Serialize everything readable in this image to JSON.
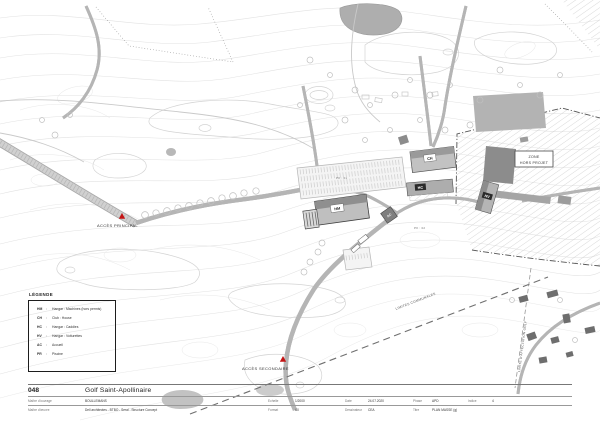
{
  "legend": {
    "title": "LÉGENDE",
    "sep": ":",
    "entries": [
      {
        "code": "HM",
        "label": "Hangar : Machines (hors permis)"
      },
      {
        "code": "CH",
        "label": "Club : House"
      },
      {
        "code": "HC",
        "label": "Hangar : Caddies"
      },
      {
        "code": "HV",
        "label": "Hangar : Voiturettes"
      },
      {
        "code": "AC",
        "label": "Accueil"
      },
      {
        "code": "PR",
        "label": "Piscine"
      }
    ]
  },
  "map": {
    "labels": {
      "access_main": "ACCÈS PRINCIPAL",
      "access_secondary": "ACCÈS SECONDAIRE",
      "zone_line1": "ZONE",
      "zone_line2": "HORS PROJET",
      "limit_communal": "LIMITES COMMUNALES",
      "limit_golf": "LIMITE D'AFFECTATION GOLF",
      "pk1": "PK : 01",
      "pk2": "PK : 02",
      "b_hm": "HM",
      "b_ch": "CH",
      "b_hc": "HC",
      "b_hv": "HV",
      "b_ac": "AC"
    },
    "colors": {
      "marker_red": "#c41414",
      "building_gray": "#9a9a9a",
      "hatch_gray": "#c9c9c9"
    }
  },
  "titleblock": {
    "number": "048",
    "project": "Golf Saint-Apollinaire",
    "row1": {
      "client_label": "Maître d'ouvrage",
      "client_value": "BOULLEMANS",
      "scale_label": "Echelle",
      "scale_value": "1/2000",
      "date_label": "Date",
      "date_value": "24.07.2020",
      "phase_label": "Phase",
      "phase_value": "APD",
      "index_label": "Indice",
      "index_value": "4"
    },
    "row2": {
      "architect_label": "Maître d'œuvre",
      "architect_value": "Dell architectes - BTBO - Seral - Structure Concept",
      "format_label": "Format",
      "format_value": "A0",
      "drafter_label": "Dessinateur",
      "drafter_value": "CEA",
      "title_label": "Titre",
      "title_value": "PLAN MASSE (g)"
    }
  }
}
